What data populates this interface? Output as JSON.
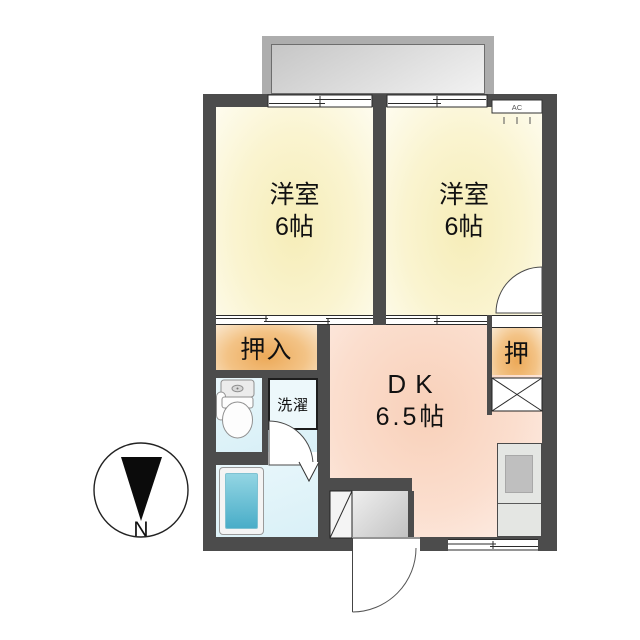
{
  "plan": {
    "type": "apartment-floor-plan",
    "bedroom_left": {
      "name": "洋室",
      "size": "6帖"
    },
    "bedroom_right": {
      "name": "洋室",
      "size": "6帖"
    },
    "dining_kitchen": {
      "name": "DK",
      "size": "6.5帖"
    },
    "closet_main": {
      "name": "押入"
    },
    "closet_small": {
      "name": "押"
    },
    "laundry": {
      "name": "洗濯"
    },
    "air_conditioner": {
      "label": "AC"
    },
    "compass": {
      "label": "N",
      "north_direction": "down"
    }
  },
  "colors": {
    "wall": "#4C4C4C",
    "bedroom_fill": "#F6EDB8",
    "dk_fill": "#F8D0B9",
    "closet_fill": "#ECA958",
    "wet_area_fill": "#DFF2F8",
    "bathtub_fill": "#49ADC8",
    "balcony_fill": "#ADADAD",
    "entrance_floor": "#C2C2C2",
    "kitchen_counter": "#E4E6E3"
  }
}
